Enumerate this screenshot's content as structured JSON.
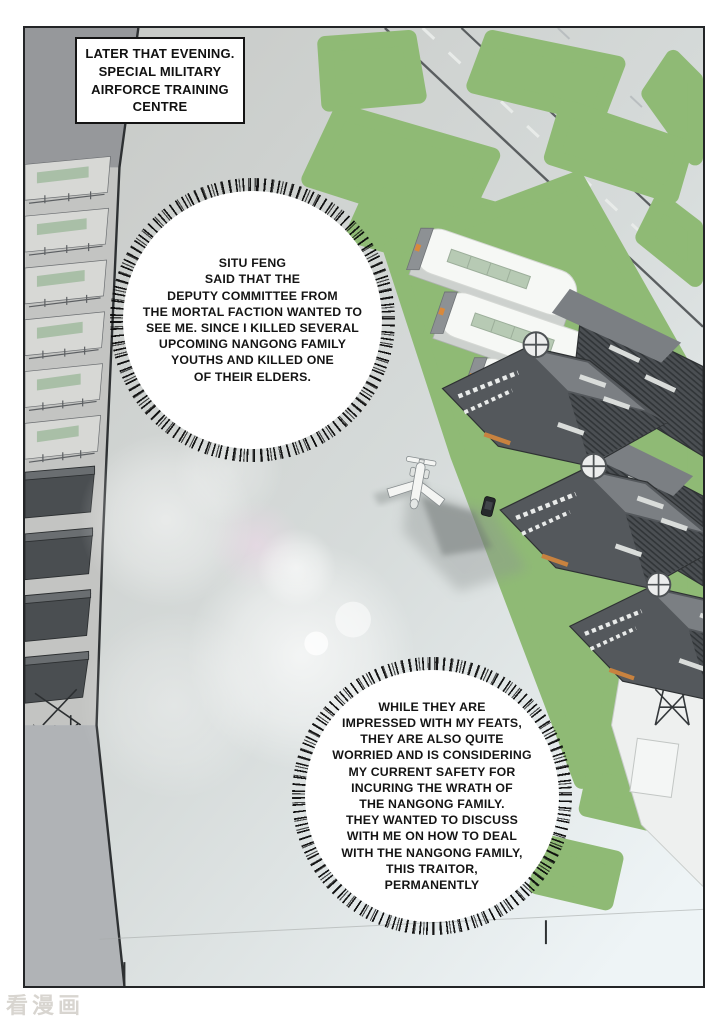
{
  "page": {
    "watermark": "看漫画",
    "background": "#ffffff"
  },
  "panel": {
    "caption": {
      "text": "LATER THAT EVENING.\nSPECIAL MILITARY\nAIRFORCE TRAINING\nCENTRE"
    },
    "speech_bubbles": [
      {
        "id": "bubble-1",
        "text": "SITU FENG\nSAID THAT THE\nDEPUTY COMMITTEE FROM\nTHE MORTAL FACTION WANTED TO\nSEE ME. SINCE I KILLED SEVERAL\nUPCOMING NANGONG FAMILY\nYOUTHS AND KILLED ONE\nOF THEIR ELDERS."
      },
      {
        "id": "bubble-2",
        "text": "WHILE THEY ARE\nIMPRESSED WITH MY FEATS,\nTHEY ARE ALSO QUITE\nWORRIED AND IS CONSIDERING\nMY CURRENT SAFETY FOR\nINCURING THE WRATH OF\nTHE NANGONG FAMILY.\nTHEY WANTED TO DISCUSS\nWITH ME ON HOW TO DEAL\nWITH THE NANGONG FAMILY,\nTHIS TRAITOR,\nPERMANENTLY"
      }
    ],
    "scene": {
      "description": "Isometric aerial view of a military airforce training centre at evening: diagonal runway with dashed centerline, green fields, three white quonset hangars, dark armored buildings with radar dishes and orange accents, terraced barracks block on the left, a small white jet and a car on the tarmac, lens flares.",
      "colors": {
        "tarmac": "#c7c9c6",
        "tarmac_light": "#eef4f6",
        "grass": "#8fba75",
        "hangar_white": "#f6f8f5",
        "skylight_green": "#b7cab4",
        "building_dark": "#54585c",
        "building_mid": "#7b7f83",
        "roof_hatch": "#313538",
        "accent_orange": "#d9893b",
        "wall_gray": "#96989b",
        "slab_light": "#d7d8d5",
        "slab_dark": "#4a4e51",
        "outline": "#2e3133",
        "flare_pink": "#f0d9ea"
      }
    }
  }
}
